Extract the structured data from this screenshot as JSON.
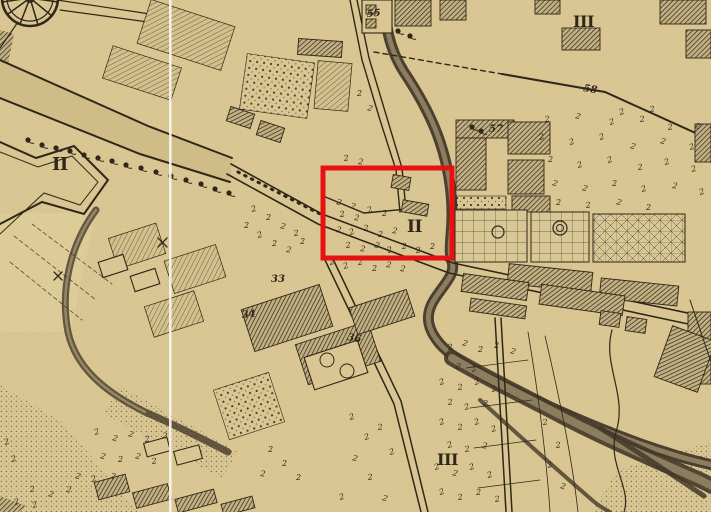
{
  "meta": {
    "description": "Engraved 18th-century style city plan, sepia paper, with red annotation rectangle highlighting district II"
  },
  "palette": {
    "paper": "#d9c693",
    "paper_dark": "#cfbc87",
    "glacis": "#ddcb98",
    "ink": "#2f2718",
    "river_dark": "#44392a",
    "river_mid": "#8d7d5f",
    "red": "#e81111",
    "seam": "#f8f5ec"
  },
  "highlight_box": {
    "x": 323,
    "y": 168,
    "w": 129,
    "h": 90,
    "stroke_w": 5
  },
  "seam": {
    "x": 169,
    "w": 2.6,
    "opacity": 0.92
  },
  "labels": {
    "districts": [
      {
        "t": "II",
        "x": 52,
        "y": 170,
        "s": 18,
        "r": 0
      },
      {
        "t": "II",
        "x": 407,
        "y": 232,
        "s": 17,
        "r": 0
      },
      {
        "t": "III",
        "x": 573,
        "y": 27,
        "s": 16,
        "r": 0
      },
      {
        "t": "III",
        "x": 437,
        "y": 465,
        "s": 16,
        "r": 0
      }
    ],
    "plots": [
      {
        "t": "55",
        "x": 367,
        "y": 17,
        "s": 10,
        "r": -5
      },
      {
        "t": "57",
        "x": 489,
        "y": 132,
        "s": 10,
        "r": 0
      },
      {
        "t": "58",
        "x": 583,
        "y": 91,
        "s": 10,
        "r": 9
      },
      {
        "t": "33",
        "x": 271,
        "y": 282,
        "s": 10,
        "r": 0
      },
      {
        "t": "34",
        "x": 242,
        "y": 318,
        "s": 10,
        "r": -5
      },
      {
        "t": "36",
        "x": 347,
        "y": 340,
        "s": 10,
        "r": 10
      }
    ]
  },
  "regions": [
    {
      "pts": "0,60 148,126 232,158 230,182 140,154 0,98",
      "f": "#cfbc87"
    },
    {
      "pts": "0,214 96,212 70,332 0,332",
      "f": "#ddcb98"
    },
    {
      "pts": "0,385 62,422 138,512 0,512",
      "f": "url:p-stip"
    },
    {
      "pts": "120,386 238,452 222,478 104,414",
      "f": "url:p-stip"
    },
    {
      "pts": "618,470 711,442 711,512 592,512",
      "f": "url:p-stip"
    },
    {
      "pts": "0,30 14,34 8,64 0,62",
      "f": "url:p-hatch"
    },
    {
      "pts": "0,496 26,506 18,512 0,512",
      "f": "url:p-hatch"
    }
  ],
  "water": [
    {
      "d": "M96,210 C70,245 60,290 68,332 C76,368 105,392 145,412 C175,425 205,440 228,452",
      "w": 7,
      "c": "river_dark",
      "o": 0.8
    },
    {
      "d": "M96,210 C70,245 60,290 68,332 C76,368 105,392 145,412",
      "w": 2.5,
      "c": "paper",
      "o": 0.45
    },
    {
      "d": "M388,-4 C382,20 390,50 404,72 C420,96 432,118 440,142 C448,166 452,190 452,214 C452,236 448,250 452,262 C456,274 444,284 434,300 C424,316 428,330 440,344 C456,362 490,380 530,398 C570,416 620,438 665,452 C692,461 706,463 712,465",
      "w": 11,
      "c": "river_dark",
      "o": 0.95
    },
    {
      "d": "M388,-4 C382,20 390,50 404,72 C420,96 432,118 440,142 C448,166 452,190 452,214 C452,236 448,250 452,262 C456,274 444,284 434,300 C424,316 428,330 440,344 C456,362 490,380 530,398 C570,416 620,438 665,452 C692,461 706,463 712,465",
      "w": 5,
      "c": "river_mid",
      "dash": "2,2"
    },
    {
      "d": "M452,358 C486,378 524,396 562,416 C600,436 650,458 700,480 C706,483 710,485 712,486",
      "w": 16,
      "c": "river_dark",
      "o": 0.9
    },
    {
      "d": "M452,358 C486,378 524,396 562,416 C600,436 650,458 700,480 C706,483 710,485 712,486",
      "w": 8,
      "c": "river_mid",
      "dash": "2,2"
    },
    {
      "d": "M600,428 C632,448 668,472 704,496",
      "w": 5,
      "c": "river_dark",
      "o": 0.85
    },
    {
      "d": "M480,400 C515,432 555,468 592,500 C600,507 606,510 610,512",
      "w": 4,
      "c": "river_dark",
      "o": 0.8
    }
  ],
  "roads": [
    {
      "d": "M0,60 L148,126 L232,158",
      "w": 2
    },
    {
      "d": "M0,98 L140,154 L230,182",
      "w": 2
    },
    {
      "d": "M231,164 L322,214 L453,263 L711,318",
      "w": 1.6
    },
    {
      "d": "M227,174 L318,224 L449,273 L707,328",
      "w": 1.6
    },
    {
      "d": "M325,260 L394,404 L421,512",
      "w": 1.5
    },
    {
      "d": "M332,257 L401,401 L428,512",
      "w": 1.5
    },
    {
      "d": "M495,318 L506,512",
      "w": 1.5
    },
    {
      "d": "M501,318 L512,512",
      "w": 1.5
    },
    {
      "d": "M374,52 L502,74",
      "w": 1.4,
      "dash": "5,4"
    },
    {
      "d": "M502,74 L605,92 L711,140",
      "w": 2
    },
    {
      "d": "M350,0 L362,60 L380,120 L396,170 L400,212",
      "w": 1.4
    },
    {
      "d": "M357,0 L369,58 L387,118 L402,168 L406,210",
      "w": 1.4
    },
    {
      "d": "M323,196 L364,213 L408,209",
      "w": 1.4
    },
    {
      "d": "M238,172 L320,214",
      "w": 3,
      "dash": "1.5,6"
    },
    {
      "d": "M57,0 L150,14",
      "w": 1.2
    },
    {
      "d": "M60,10 L148,22",
      "w": 1.2
    },
    {
      "d": "M18,22 L0,48",
      "w": 1.2
    }
  ],
  "details": [
    {
      "d": "M0,142 L36,158 L74,146 L108,180 L84,214 L42,202 L0,224",
      "w": 2
    },
    {
      "d": "M0,152 L38,167 L72,156 L98,182 L80,205 L44,193 L0,234",
      "w": 1
    },
    {
      "d": "M30,-2 L58,2 M30,-2 L52,16 M30,-2 L38,25 M30,-2 L20,24 M30,-2 L8,14 M30,-2 L2,2",
      "w": 1.5
    },
    {
      "d": "M14,236 L96,300",
      "w": 0.9,
      "dash": "4,3",
      "o": 0.7
    },
    {
      "d": "M10,262 L82,320",
      "w": 0.9,
      "dash": "4,3",
      "o": 0.7
    },
    {
      "d": "M32,224 L112,284",
      "w": 0.9,
      "dash": "4,3",
      "o": 0.7
    },
    {
      "d": "M528,332 C538,392 546,452 550,512",
      "w": 0.8
    },
    {
      "d": "M545,336 C560,400 572,458 578,512",
      "w": 0.8
    },
    {
      "d": "M466,368 L528,360 M470,408 L532,400 M474,448 L536,440 M478,488 L540,480",
      "w": 0.7
    },
    {
      "d": "M612,330 C602,365 628,395 616,432 C607,464 632,488 624,512",
      "w": 1.2
    },
    {
      "d": "M158,238 L167,247 M167,238 L158,247",
      "w": 1.3
    },
    {
      "d": "M54,272 L62,280 M62,272 L54,280",
      "w": 1.3
    },
    {
      "d": "M690,300 L711,362",
      "w": 1
    }
  ],
  "circles": [
    {
      "cx": 30,
      "cy": -2,
      "r": 28,
      "w": 2.5
    },
    {
      "cx": 30,
      "cy": -2,
      "r": 23,
      "w": 1.2
    },
    {
      "cx": 30,
      "cy": -2,
      "r": 4,
      "w": 2
    },
    {
      "cx": 498,
      "cy": 232,
      "r": 6,
      "w": 1.2
    },
    {
      "cx": 560,
      "cy": 228,
      "r": 7,
      "w": 1.2
    },
    {
      "cx": 560,
      "cy": 228,
      "r": 3.5,
      "w": 1
    },
    {
      "cx": 327,
      "cy": 360,
      "r": 7,
      "w": 1
    },
    {
      "cx": 347,
      "cy": 371,
      "r": 7,
      "w": 1
    }
  ],
  "buildings": [
    [
      "fine",
      142,
      12,
      88,
      46,
      18
    ],
    [
      "fine",
      106,
      56,
      72,
      34,
      18
    ],
    [
      "fine",
      316,
      62,
      34,
      48,
      5
    ],
    [
      "fine",
      112,
      230,
      50,
      32,
      -18
    ],
    [
      "fine",
      168,
      252,
      54,
      34,
      -18
    ],
    [
      "fine",
      148,
      298,
      52,
      32,
      -18
    ],
    [
      "hatch",
      228,
      110,
      25,
      15,
      18
    ],
    [
      "hatch",
      258,
      124,
      25,
      15,
      18
    ],
    [
      "dots",
      243,
      58,
      68,
      56,
      8
    ],
    [
      "outline",
      362,
      0,
      30,
      33,
      0
    ],
    [
      "hatch",
      366,
      5,
      10,
      9,
      0
    ],
    [
      "hatch",
      366,
      19,
      10,
      9,
      0
    ],
    [
      "hatch",
      298,
      40,
      44,
      16,
      4
    ],
    [
      "hatch",
      395,
      0,
      36,
      26,
      0
    ],
    [
      "hatch",
      440,
      0,
      26,
      20,
      0
    ],
    [
      "hatch",
      535,
      0,
      25,
      14,
      0
    ],
    [
      "hatch",
      562,
      28,
      38,
      22,
      0
    ],
    [
      "hatch",
      660,
      0,
      46,
      24,
      0
    ],
    [
      "hatch",
      686,
      30,
      25,
      28,
      0
    ],
    [
      "hatch",
      695,
      124,
      16,
      38,
      0
    ],
    [
      "hatch",
      456,
      120,
      58,
      18,
      0
    ],
    [
      "hatch",
      456,
      138,
      30,
      52,
      0
    ],
    [
      "hatch",
      508,
      122,
      42,
      32,
      0
    ],
    [
      "hatch",
      508,
      160,
      36,
      34,
      0
    ],
    [
      "hatch",
      512,
      196,
      38,
      16,
      0
    ],
    [
      "dots",
      456,
      196,
      50,
      13,
      0
    ],
    [
      "grid",
      455,
      210,
      72,
      52,
      0
    ],
    [
      "grid",
      531,
      212,
      58,
      50,
      0
    ],
    [
      "gridx",
      593,
      214,
      92,
      48,
      0
    ],
    [
      "hatch",
      508,
      268,
      84,
      20,
      6
    ],
    [
      "hatch",
      600,
      282,
      78,
      20,
      6
    ],
    [
      "hatch",
      688,
      312,
      23,
      72,
      0
    ],
    [
      "hatch",
      662,
      332,
      46,
      54,
      20
    ],
    [
      "hatch",
      462,
      278,
      66,
      18,
      8
    ],
    [
      "hatch",
      540,
      290,
      84,
      20,
      8
    ],
    [
      "hatch",
      470,
      302,
      56,
      13,
      8
    ],
    [
      "hatch",
      600,
      312,
      20,
      14,
      8
    ],
    [
      "hatch",
      626,
      318,
      20,
      14,
      8
    ],
    [
      "hatch",
      246,
      296,
      82,
      44,
      -18
    ],
    [
      "hatch",
      300,
      332,
      76,
      42,
      -18
    ],
    [
      "hatch",
      352,
      298,
      60,
      28,
      -18
    ],
    [
      "outline",
      308,
      348,
      56,
      34,
      -18
    ],
    [
      "dots",
      220,
      380,
      58,
      52,
      -18
    ],
    [
      "outline",
      100,
      258,
      26,
      16,
      -18
    ],
    [
      "outline",
      132,
      272,
      26,
      16,
      -18
    ],
    [
      "hatch",
      392,
      176,
      18,
      13,
      10
    ],
    [
      "hatch",
      402,
      202,
      26,
      12,
      10
    ],
    [
      "hatch",
      96,
      478,
      32,
      18,
      -15
    ],
    [
      "hatch",
      134,
      488,
      36,
      16,
      -15
    ],
    [
      "hatch",
      176,
      494,
      40,
      14,
      -15
    ],
    [
      "hatch",
      222,
      500,
      32,
      12,
      -15
    ],
    [
      "outline",
      145,
      440,
      24,
      14,
      -15
    ],
    [
      "outline",
      175,
      448,
      26,
      14,
      -15
    ]
  ],
  "trees": {
    "blobs": [
      [
        28,
        140
      ],
      [
        42,
        145
      ],
      [
        56,
        148
      ],
      [
        70,
        151
      ],
      [
        84,
        155
      ],
      [
        98,
        158
      ],
      [
        112,
        161
      ],
      [
        126,
        165
      ],
      [
        141,
        168
      ],
      [
        156,
        172
      ],
      [
        171,
        176
      ],
      [
        186,
        180
      ],
      [
        201,
        184
      ],
      [
        215,
        189
      ],
      [
        229,
        193
      ],
      [
        398,
        31
      ],
      [
        410,
        36
      ],
      [
        472,
        127
      ],
      [
        481,
        131
      ]
    ],
    "glyphs": [
      [
        336,
        204
      ],
      [
        350,
        208
      ],
      [
        340,
        217
      ],
      [
        354,
        220
      ],
      [
        368,
        213
      ],
      [
        382,
        216
      ],
      [
        336,
        232
      ],
      [
        350,
        235
      ],
      [
        364,
        231
      ],
      [
        378,
        237
      ],
      [
        392,
        233
      ],
      [
        346,
        248
      ],
      [
        360,
        251
      ],
      [
        374,
        247
      ],
      [
        388,
        253
      ],
      [
        402,
        249
      ],
      [
        416,
        253
      ],
      [
        430,
        249
      ],
      [
        344,
        161
      ],
      [
        358,
        164
      ],
      [
        330,
        265
      ],
      [
        344,
        269
      ],
      [
        358,
        265
      ],
      [
        372,
        271
      ],
      [
        386,
        267
      ],
      [
        400,
        271
      ],
      [
        252,
        212
      ],
      [
        266,
        220
      ],
      [
        280,
        228
      ],
      [
        294,
        236
      ],
      [
        258,
        238
      ],
      [
        272,
        246
      ],
      [
        286,
        252
      ],
      [
        300,
        244
      ],
      [
        244,
        228
      ],
      [
        545,
        122
      ],
      [
        575,
        118
      ],
      [
        610,
        125
      ],
      [
        640,
        122
      ],
      [
        668,
        130
      ],
      [
        695,
        128
      ],
      [
        540,
        140
      ],
      [
        570,
        145
      ],
      [
        600,
        140
      ],
      [
        630,
        148
      ],
      [
        660,
        143
      ],
      [
        690,
        150
      ],
      [
        548,
        162
      ],
      [
        578,
        168
      ],
      [
        608,
        163
      ],
      [
        638,
        170
      ],
      [
        665,
        165
      ],
      [
        692,
        172
      ],
      [
        552,
        185
      ],
      [
        582,
        190
      ],
      [
        612,
        186
      ],
      [
        642,
        192
      ],
      [
        672,
        188
      ],
      [
        700,
        195
      ],
      [
        556,
        205
      ],
      [
        586,
        208
      ],
      [
        616,
        204
      ],
      [
        646,
        210
      ],
      [
        620,
        115
      ],
      [
        650,
        112
      ],
      [
        357,
        96
      ],
      [
        367,
        110
      ],
      [
        448,
        350
      ],
      [
        462,
        345
      ],
      [
        478,
        352
      ],
      [
        494,
        348
      ],
      [
        510,
        353
      ],
      [
        455,
        368
      ],
      [
        472,
        372
      ],
      [
        440,
        385
      ],
      [
        458,
        390
      ],
      [
        475,
        385
      ],
      [
        492,
        392
      ],
      [
        448,
        405
      ],
      [
        465,
        410
      ],
      [
        482,
        405
      ],
      [
        440,
        425
      ],
      [
        458,
        430
      ],
      [
        475,
        425
      ],
      [
        492,
        432
      ],
      [
        448,
        448
      ],
      [
        465,
        452
      ],
      [
        482,
        448
      ],
      [
        435,
        470
      ],
      [
        452,
        475
      ],
      [
        470,
        470
      ],
      [
        488,
        478
      ],
      [
        440,
        495
      ],
      [
        458,
        500
      ],
      [
        476,
        495
      ],
      [
        495,
        502
      ],
      [
        543,
        425
      ],
      [
        556,
        448
      ],
      [
        548,
        468
      ],
      [
        560,
        488
      ],
      [
        95,
        435
      ],
      [
        112,
        440
      ],
      [
        128,
        436
      ],
      [
        145,
        442
      ],
      [
        162,
        438
      ],
      [
        100,
        458
      ],
      [
        118,
        462
      ],
      [
        135,
        458
      ],
      [
        152,
        464
      ],
      [
        75,
        478
      ],
      [
        92,
        482
      ],
      [
        110,
        478
      ],
      [
        30,
        492
      ],
      [
        48,
        496
      ],
      [
        66,
        492
      ],
      [
        15,
        505
      ],
      [
        33,
        508
      ],
      [
        5,
        445
      ],
      [
        12,
        462
      ],
      [
        350,
        420
      ],
      [
        365,
        440
      ],
      [
        352,
        460
      ],
      [
        368,
        480
      ],
      [
        382,
        500
      ],
      [
        340,
        500
      ],
      [
        390,
        455
      ],
      [
        378,
        430
      ],
      [
        268,
        452
      ],
      [
        282,
        466
      ],
      [
        296,
        480
      ],
      [
        260,
        476
      ]
    ]
  }
}
